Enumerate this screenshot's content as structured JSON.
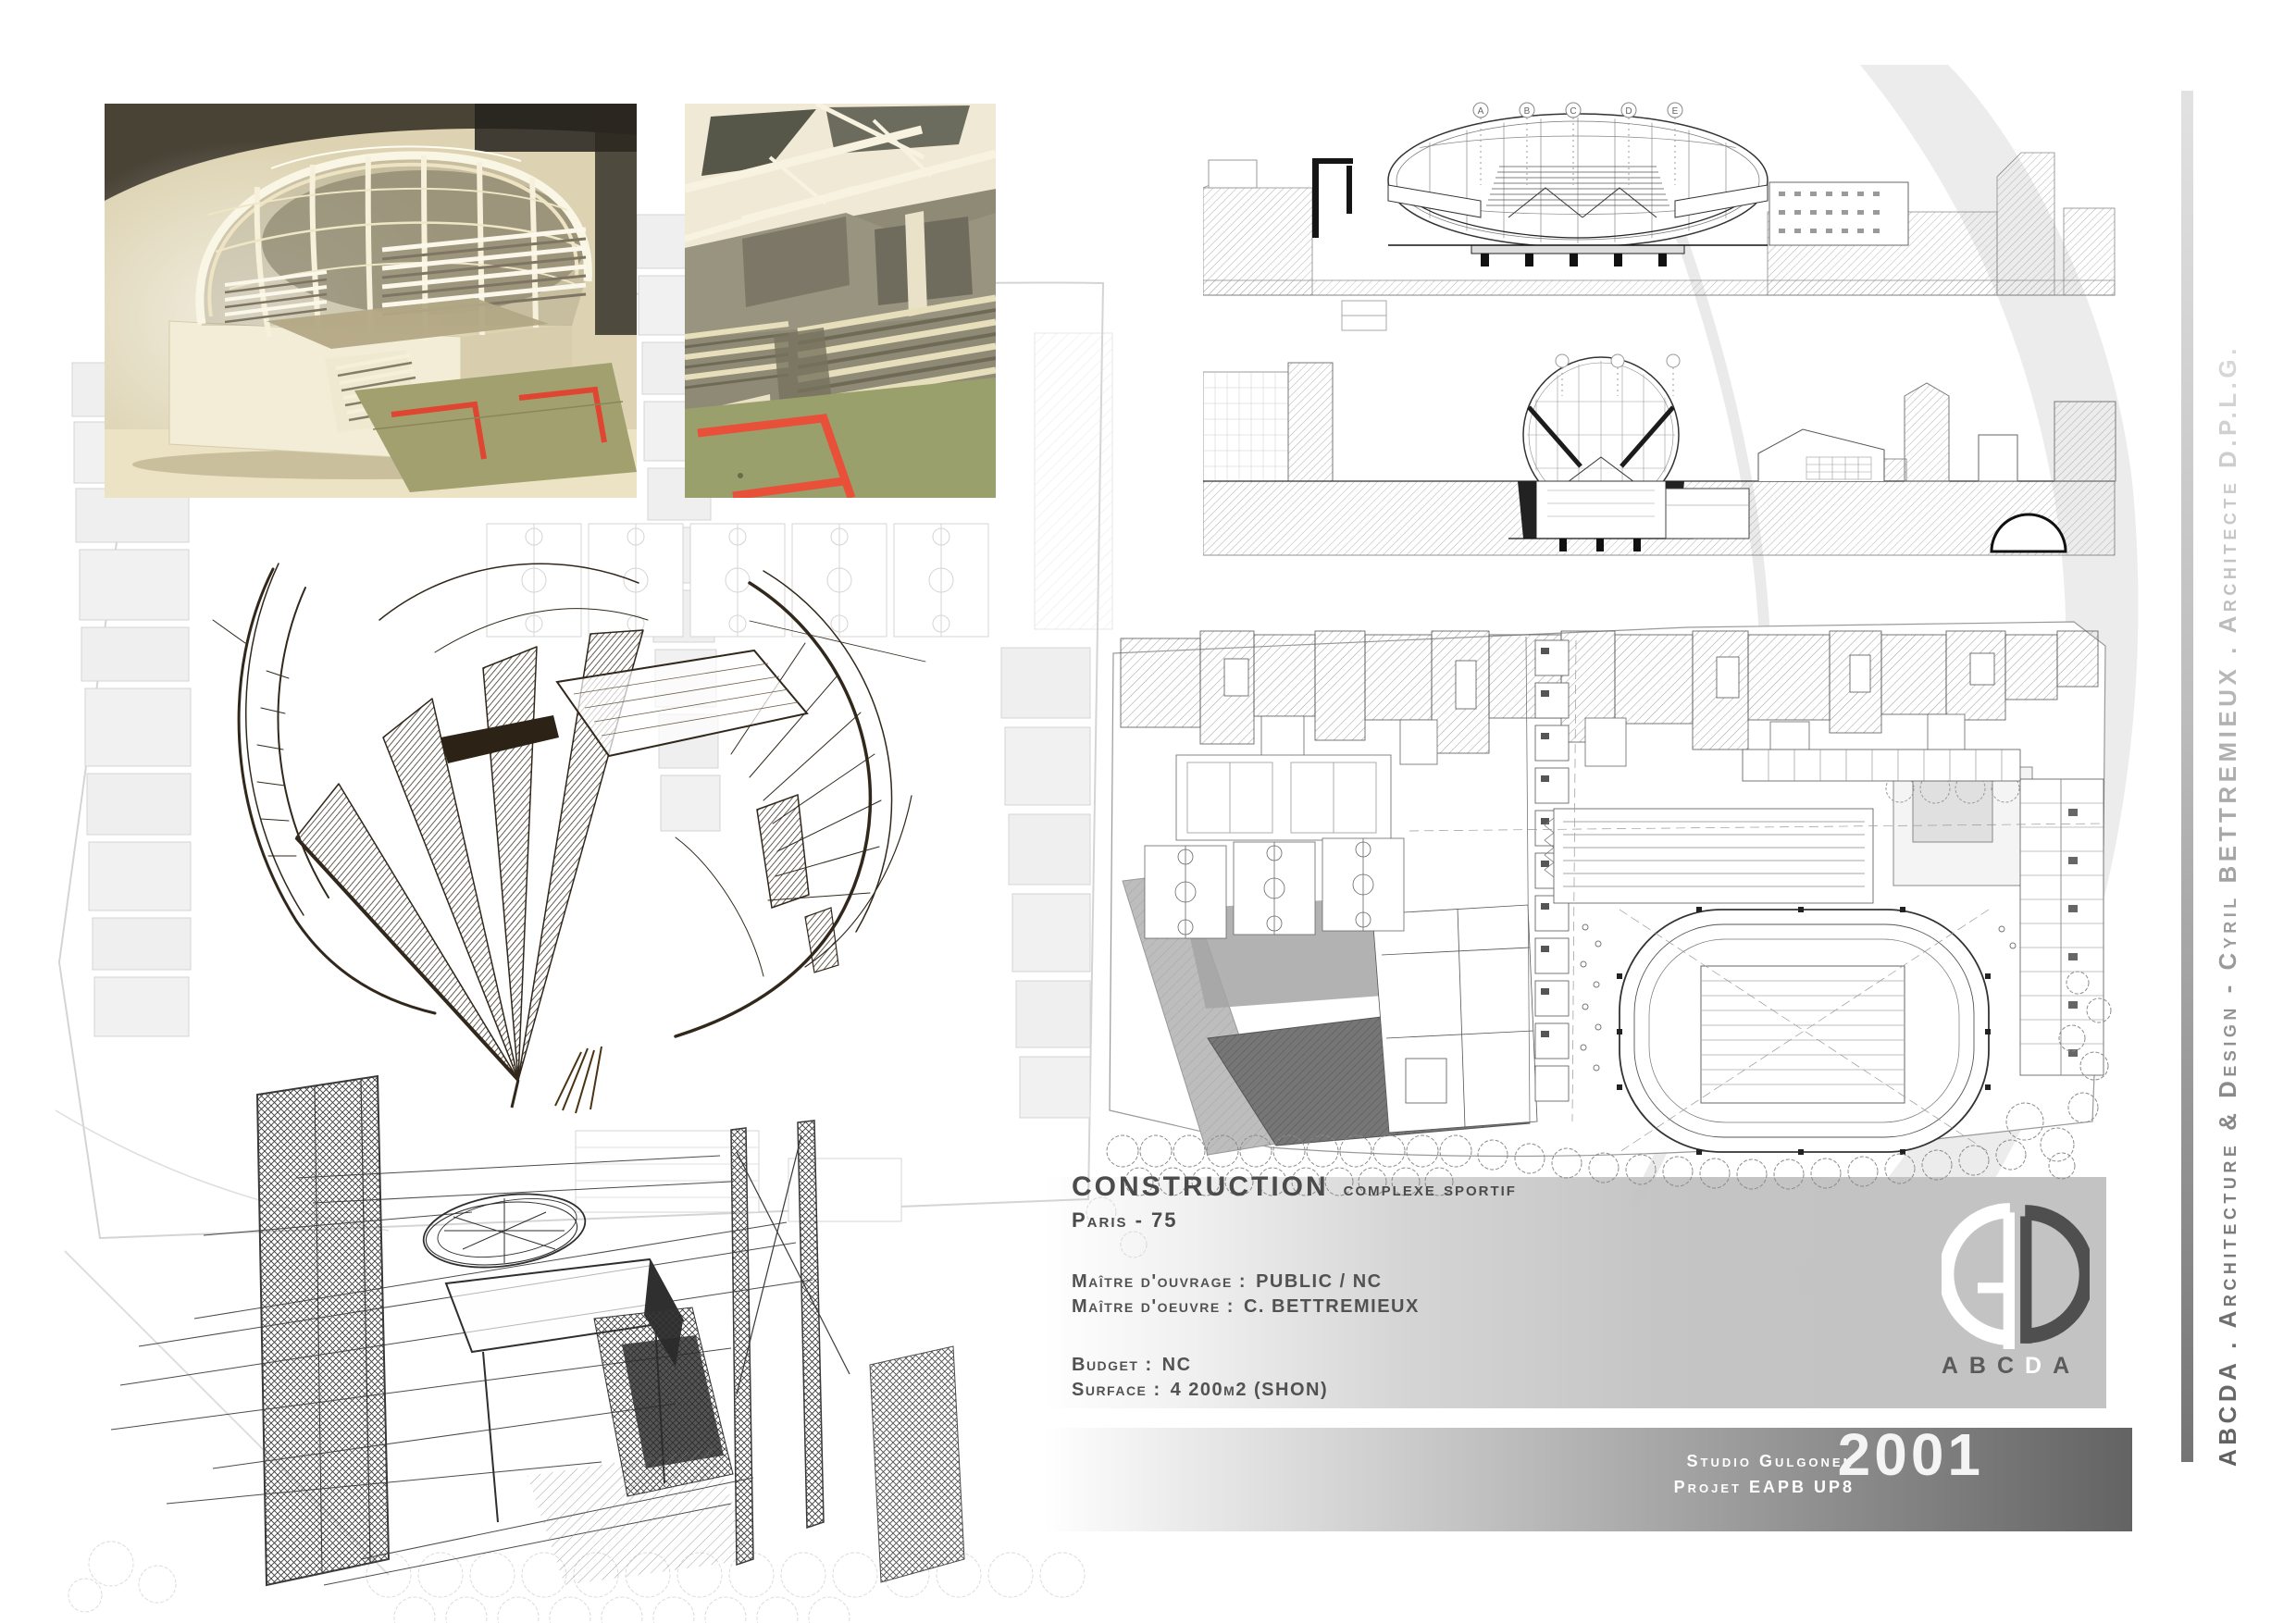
{
  "project": {
    "title": "CONSTRUCTION",
    "subtitle": "complexe sportif",
    "location": "Paris - 75",
    "fields": [
      {
        "label": "Maître d'ouvrage :",
        "value": "PUBLIC / NC"
      },
      {
        "label": "Maître d'oeuvre :",
        "value": "C. BETTREMIEUX"
      },
      {
        "label": "Budget :",
        "value": "NC"
      },
      {
        "label": "Surface :",
        "value": "4 200m2 (SHON)"
      }
    ]
  },
  "footer": {
    "studio": "Studio Gulgonen",
    "project_ref": "Projet EAPB UP8",
    "year": "2001"
  },
  "logo": {
    "letters": [
      "A",
      "B",
      "C",
      "D",
      "A"
    ]
  },
  "sidebar": {
    "credit": "ABCDA . Architecture & Design - Cyril BETTREMIEUX . Architecte D.P.L.G."
  },
  "drawings": {
    "section_grid_labels": [
      "A",
      "B",
      "C",
      "D",
      "E"
    ]
  },
  "colors": {
    "panel_gray": "#c3c3c3",
    "footer_dark": "#636363",
    "ink_gray": "#4b4b4b",
    "accent_red": "#e0452f",
    "model_cream": "#efe6c9",
    "floor_olive": "#9da06c"
  }
}
